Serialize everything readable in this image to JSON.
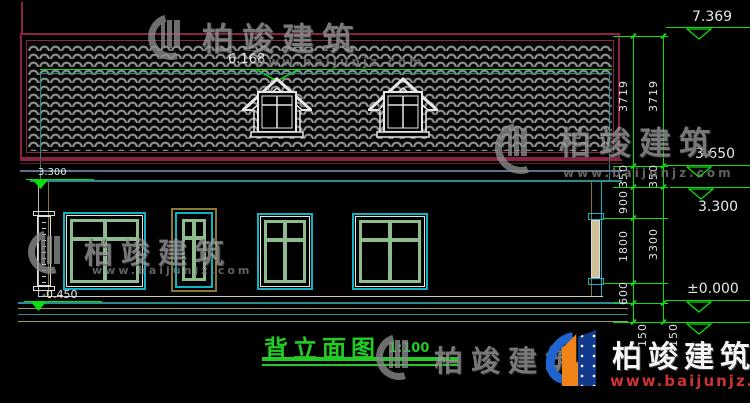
{
  "drawing": {
    "title": "背立面图",
    "scale": "1:100"
  },
  "roof": {
    "ridge_dimension": "6.168"
  },
  "elevations": {
    "right": [
      "7.369",
      "3.650",
      "3.300",
      "±0.000"
    ],
    "left": [
      "3.300",
      "-0.450"
    ]
  },
  "dims": {
    "inner": [
      "3719",
      "350",
      "900",
      "1800",
      "600",
      "150"
    ],
    "outer": [
      "3719",
      "350",
      "3300",
      "150"
    ]
  },
  "watermark": {
    "name": "柏竣建筑",
    "url": "www.baijunjz.com"
  },
  "brand": {
    "name": "柏竣建筑",
    "url": "www.baijunjz.com"
  },
  "colors": {
    "background": "#000000",
    "dimension_green": "#0ddd0d",
    "title_green": "#22cc22",
    "roof_border_maroon": "#8a2442",
    "tile_gray": "#8f8f8f",
    "window_cyan": "#12b2c4",
    "level_teal": "#2e8b8b",
    "trim_olive": "#8a7a30",
    "eave_slate": "#5d7291",
    "line_white": "#e6e6e6",
    "watermark_gray": "#8c8c8c",
    "brand_blue": "#1f64d0",
    "brand_orange": "#f08418",
    "url_red": "#cc3333"
  }
}
